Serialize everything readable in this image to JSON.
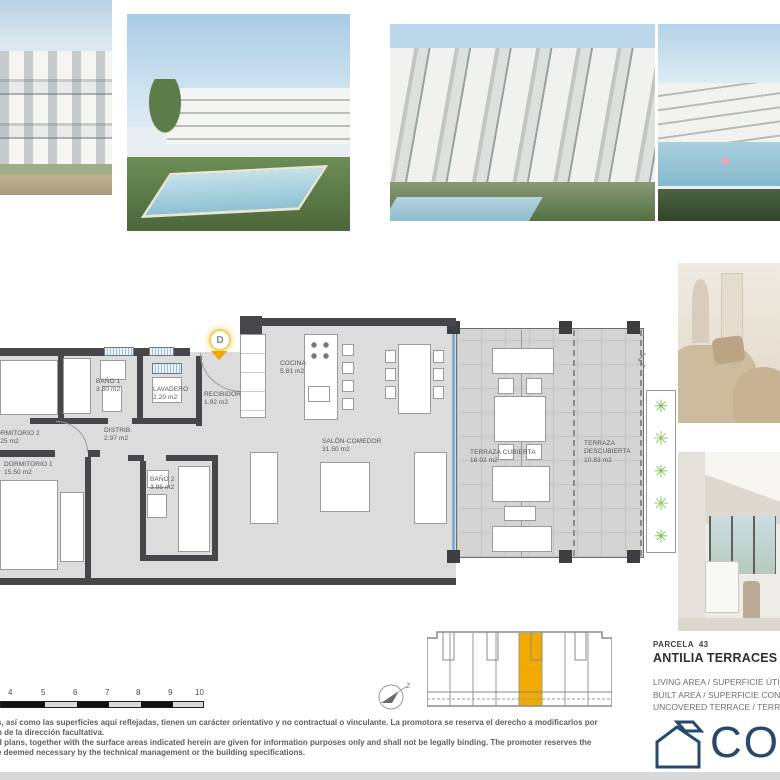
{
  "plan": {
    "entrance_marker": "D",
    "rooms": [
      {
        "name": "BAÑO 1",
        "area": "3.30 m2"
      },
      {
        "name": "LAVADERO",
        "area": "2.20 m2"
      },
      {
        "name": "RECIBIDOR",
        "area": "1.92 m2"
      },
      {
        "name": "DORMITORIO 2",
        "area": "10.25 m2"
      },
      {
        "name": "DISTRIB.",
        "area": "2.97 m2"
      },
      {
        "name": "DORMITORIO 1",
        "area": "15.50 m2"
      },
      {
        "name": "BAÑO 2",
        "area": "3.95 m2"
      },
      {
        "name": "COCINA",
        "area": "5.81 m2"
      },
      {
        "name": "SALÓN-COMEDOR",
        "area": "31.50 m2"
      },
      {
        "name": "TERRAZA CUBIERTA",
        "area": "18.02 m2"
      },
      {
        "name": "TERRAZA DESCUBIERTA",
        "area": "10.83 m2"
      }
    ]
  },
  "scale_bar": {
    "ticks": [
      "4",
      "5",
      "6",
      "7",
      "8",
      "9",
      "10"
    ]
  },
  "north": {
    "label": "z"
  },
  "key_plan": {
    "highlight_color": "#F2A900"
  },
  "project": {
    "parcela": "PARCELA  43",
    "title": "ANTILIA TERRACES IV",
    "legend": [
      "LIVING AREA / SUPERFICIE ÚTIL I",
      "BUILT AREA / SUPERFICIE CONST",
      "UNCOVERED TERRACE / TERRAZ"
    ]
  },
  "logo": {
    "text": "CON",
    "icon": "house-outline-icon",
    "color": "#27496D"
  },
  "disclaimer": {
    "lines": [
      "s, así como las superficies aquí reflejadas, tienen un carácter orientativo y no contractual o vinculante. La promotora se reserva el derecho a modificarlos por",
      "n de la dirección facultativa.",
      "d plans, together with the surface areas indicated herein are given for information purposes only and shall not be legally binding. The promoter reserves the",
      "e deemed necessary by the technical management or the building specifications."
    ]
  },
  "colors": {
    "accent_orange": "#F2A900",
    "wall_gray": "#47474B",
    "glass_blue": "#7FB0D4",
    "plan_floor": "#DCDCDC",
    "logo_navy": "#27496D"
  }
}
